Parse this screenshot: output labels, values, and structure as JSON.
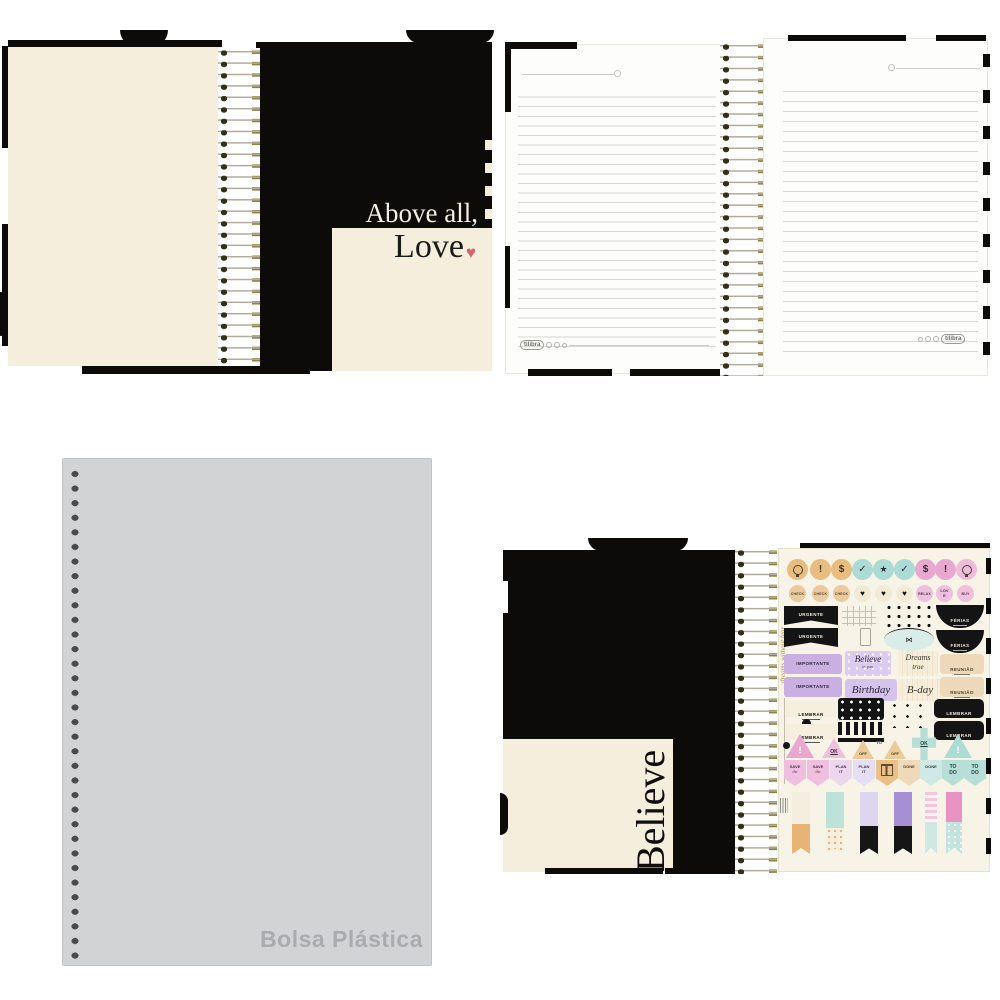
{
  "colors": {
    "cover_black": "#0c0b0a",
    "cream": "#f5eedc",
    "sticker_sheet_cream": "#f8f3e7",
    "page_white": "#fdfdfb",
    "rule_line_gray": "#d9d8d1",
    "plastic_gray": "#d2d3d5",
    "plastic_label_gray": "#a9acae",
    "spiral_gold": "#8f8140",
    "sticker_orange": "#e9bc80",
    "sticker_teal": "#abdbd4",
    "sticker_pink": "#e9a8d0",
    "sticker_lavender": "#c9afe2",
    "heart_red": "#d4646e"
  },
  "love_view": {
    "quote_line1": "Above all,",
    "quote_line2": "Love",
    "heart": "♥"
  },
  "pages_view": {
    "brand": "tilibra"
  },
  "plastic_view": {
    "label": "Bolsa Plástica"
  },
  "stickers_view": {
    "cover_word": "Believe",
    "sheet": {
      "side_script": "dreams without fear",
      "icon_glyphs": {
        "exclamation": "!",
        "dollar": "$",
        "check": "✓",
        "star": "★"
      },
      "small_circles": {
        "check": "CHECK",
        "heart": "♥",
        "relax": "RELAX",
        "love": "LOVE",
        "buy": "BUY"
      },
      "tags": {
        "urgente": "URGENTE",
        "ferias": "FÉRIAS",
        "importante": "IMPORTANTE",
        "reuniao": "REUNIÃO",
        "lembrar": "LEMBRAR"
      },
      "scripts": {
        "believe": "Believe",
        "believe_sub": "in you",
        "birthday": "Birthday",
        "dreams": "Dreams",
        "dreams_sub": "true",
        "bday": "B-day"
      },
      "badges": {
        "exclamation": "!",
        "ok": "OK",
        "off": "OFF",
        "to": "TO"
      },
      "pennants": {
        "save_top": "SAVE",
        "save_bottom": "the",
        "plan_top": "PLAN",
        "plan_bottom": "IT",
        "done": "DONE",
        "todo_top": "TO",
        "todo_bottom": "DO"
      }
    }
  }
}
